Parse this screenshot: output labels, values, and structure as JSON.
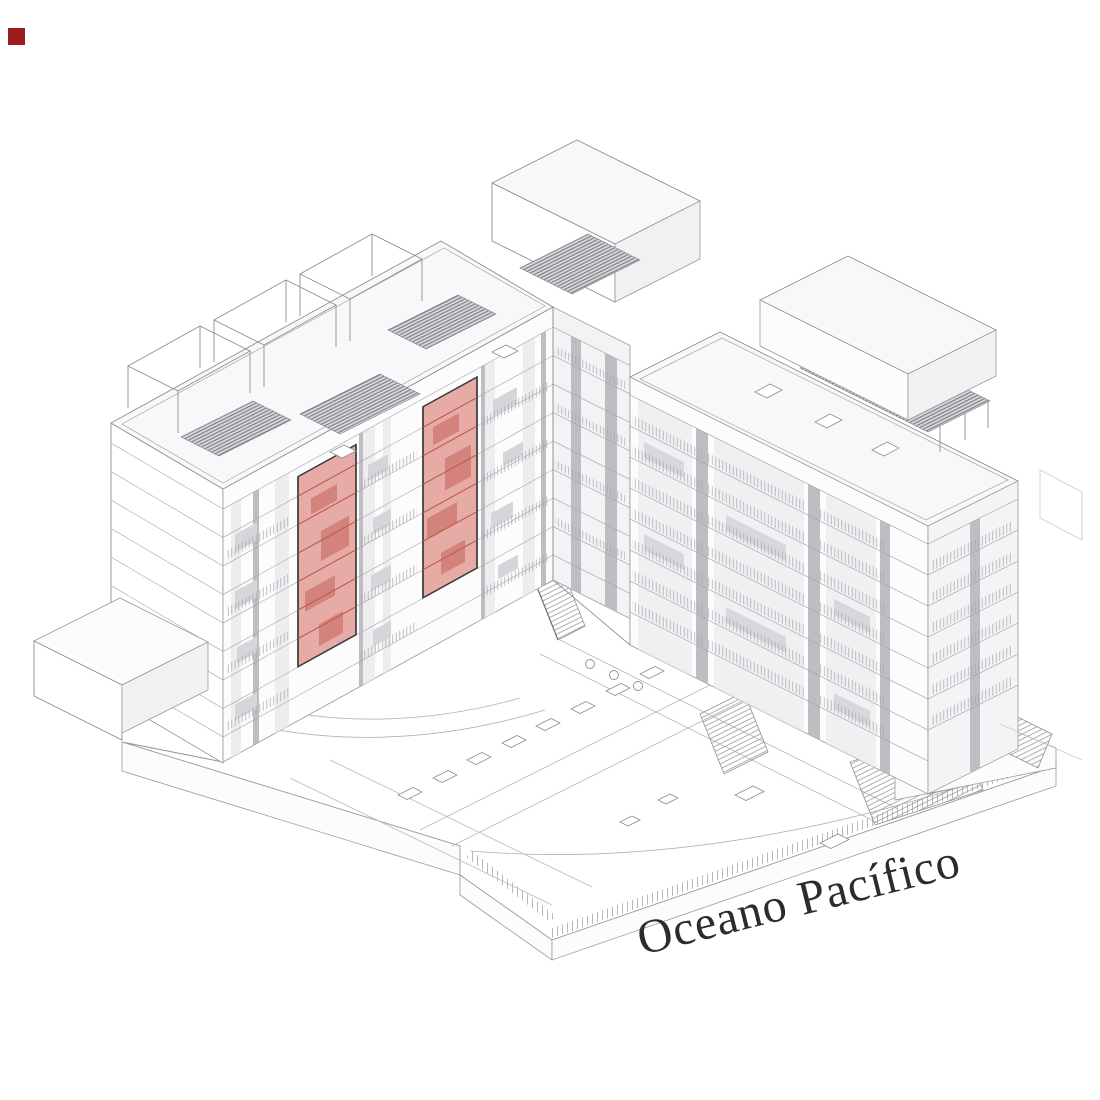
{
  "canvas": {
    "background": "#ffffff"
  },
  "marker": {
    "color": "#9d1c20"
  },
  "drawing": {
    "type": "axonometric-architecture-diagram",
    "line_color": "#8f8f95",
    "highlight": {
      "fill": "#e0938c",
      "line_color": "#b5524c",
      "outline_color": "#3a3a3e",
      "panel_count": 2
    }
  },
  "label": {
    "text": "Oceano Pacífico",
    "color": "#2c2c2f",
    "rotation_deg": -14
  }
}
